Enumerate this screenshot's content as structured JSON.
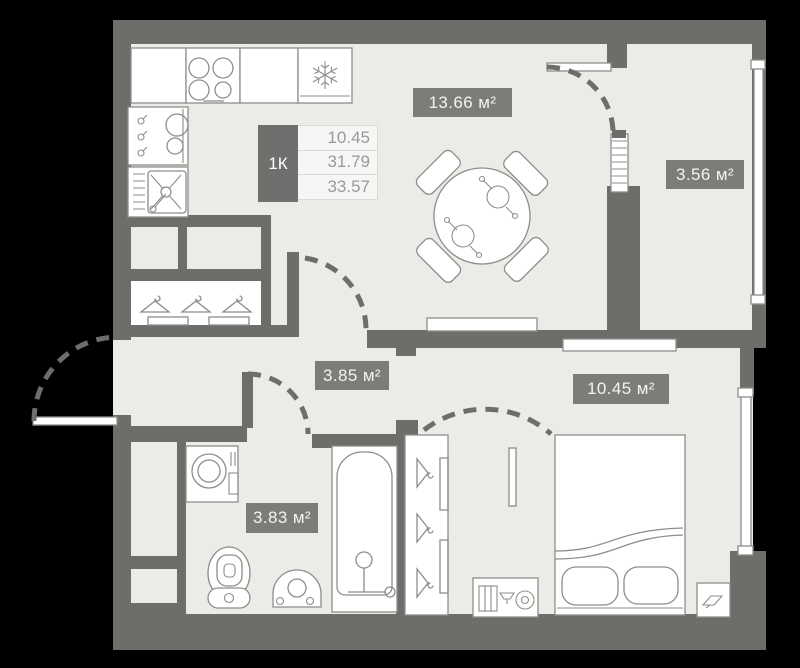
{
  "palette": {
    "floor": "#EDEBE8",
    "walls": "#6F6D6A",
    "fixture_stroke": "#8F8D8A",
    "badge_bg": "#7E7C79",
    "badge_text": "#F4F3F1",
    "legend_dark": "#716F6D",
    "legend_light": "#F7F6F4",
    "legend_text": "#9B9997",
    "bg": "#000000"
  },
  "legend": {
    "unit_type": "1К",
    "rows": [
      "10.45",
      "31.79",
      "33.57"
    ]
  },
  "rooms": [
    {
      "id": "kitchen-living",
      "label": "13.66 м²"
    },
    {
      "id": "balcony",
      "label": "3.56 м²"
    },
    {
      "id": "hallway",
      "label": "3.85 м²"
    },
    {
      "id": "bedroom",
      "label": "10.45 м²"
    },
    {
      "id": "bathroom",
      "label": "3.83 м²"
    }
  ],
  "icons": {
    "fridge": "snowflake-icon",
    "stove": "burners-icon",
    "kitchen_sink": "sink-cross-icon",
    "wardrobe": "hanger-icon",
    "ventilation": "vent-icon"
  }
}
